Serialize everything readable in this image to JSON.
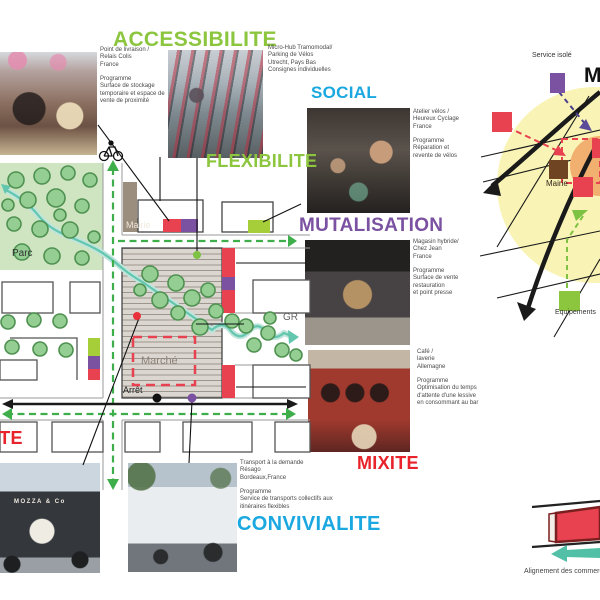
{
  "titles": {
    "accessibilite": "ACCESSIBILITE",
    "social": "SOCIAL",
    "flexibilite": "FLEXIBILITE",
    "mutalisation": "MUTALISATION",
    "mixite": "MIXITE",
    "convivialite": "CONVIVIALITE",
    "left_edge_partial": "MIXITE"
  },
  "captions": {
    "relais_colis": "Point de livraison /\nRelais Colis\nFrance\n\nProgramme\nSurface de stockage\ntemporaire et espace de\nvente de proximité",
    "micro_hub": "Micro-Hub Tramomodal/\nParking de Vélos\nUtrecht, Pays Bas\nConsignes  individuelles",
    "atelier_velos": "Atelier vélos /\nHeureux Cyclage\nFrance\n\nProgramme\nRéparation et\nrevente de vélos",
    "magasin_hybride": "Magasin hybride/\nChez Jean\nFrance\n\nProgramme\nSurface de vente\nrestauration\net point presse",
    "cafe_laverie": "Café /\nlaverie\nAllemagne\n\nProgramme\nOptimisation du temps\nd'attente d'une lessive\nen consommant au bar",
    "transport_demande": "Transport à la demande\nRésago\nBordeaux,France\n\nProgramme\nService de transports collectifs aux\nitinéraires flexibles"
  },
  "map": {
    "parc": "Parc",
    "mairie": "Mairie",
    "marche": "Marché",
    "arret": "Arrêt",
    "gr": "GR"
  },
  "right_diagram": {
    "service_isole": "Service isolé",
    "mairie": "Mairie",
    "equipement": "Equipements",
    "heading_partial": "Mutualisation"
  },
  "bottom_right": {
    "alignement": "Alignement des commerces"
  },
  "photos": {
    "mozza_label": "MOZZA & Co"
  },
  "colors": {
    "green": "#8CC63E",
    "cyan": "#1BA8E0",
    "purple": "#7B52A2",
    "red": "#E8232B",
    "teal": "#5FC4AC",
    "navy": "#4A3E8C",
    "yellow_zone": "#F9F4B5",
    "orange_zone": "#F1AF70",
    "brown": "#6F4423",
    "taupe": "#9C8E7E",
    "route_green": "#3DAE49"
  }
}
